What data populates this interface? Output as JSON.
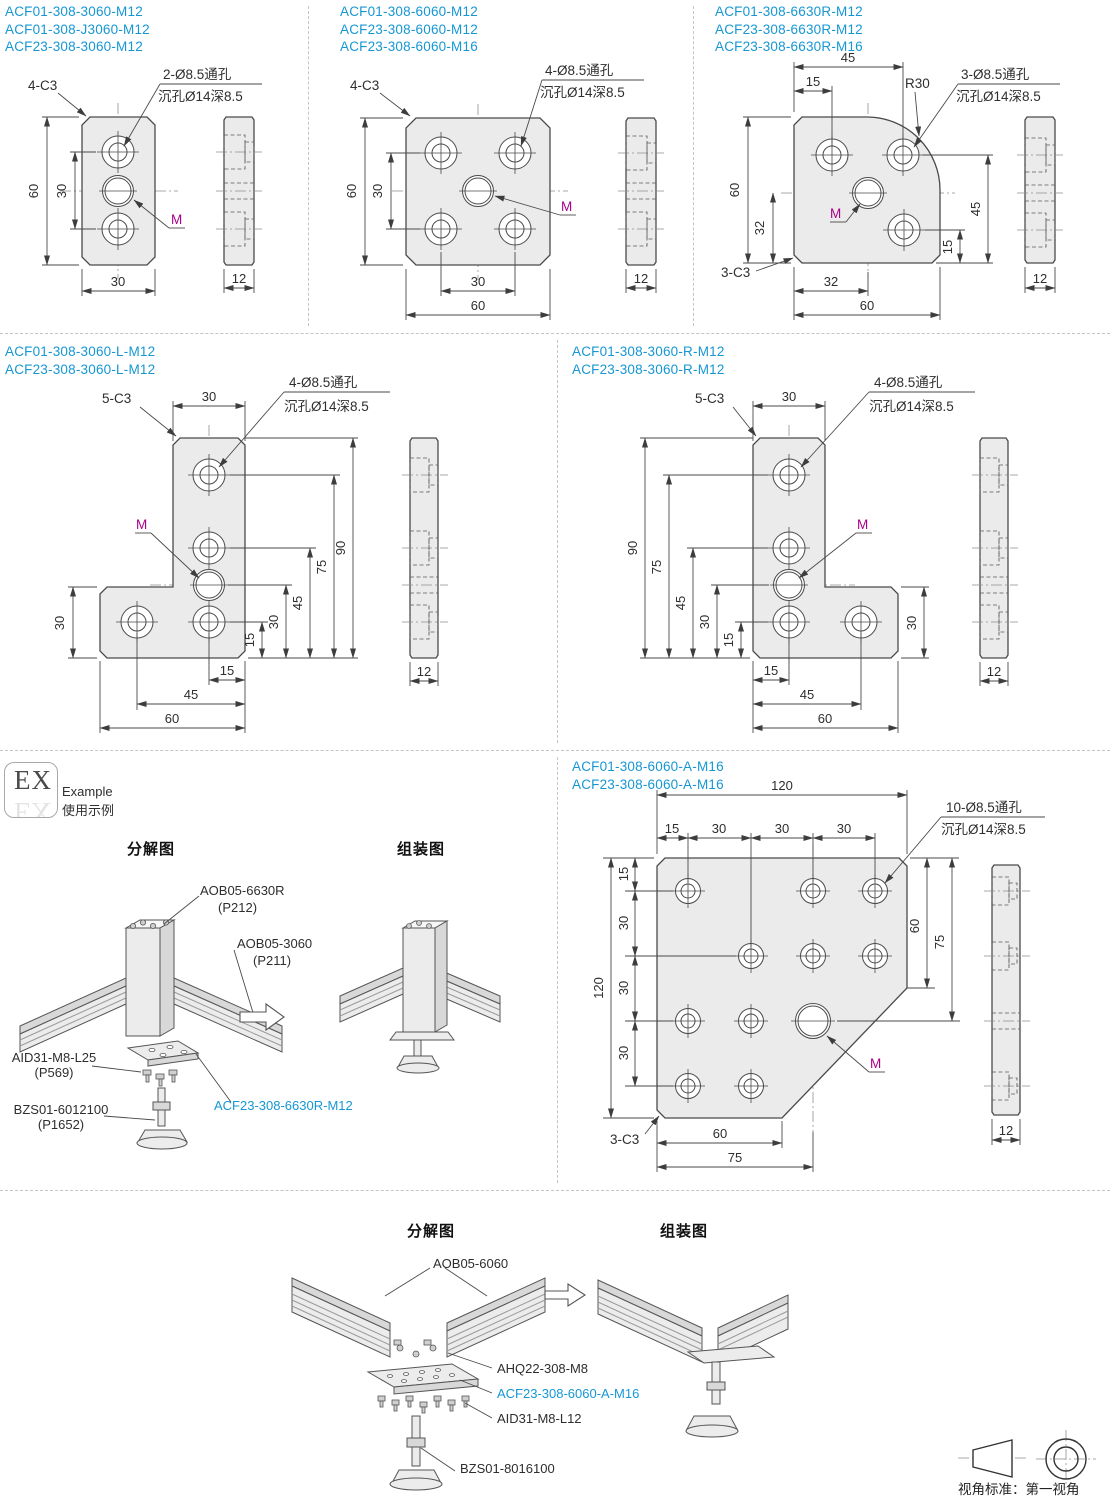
{
  "colors": {
    "accent_blue": "#1697d4",
    "m_magenta": "#aa0088",
    "line": "#4a4a4a",
    "plate_fill": "#ebebeb"
  },
  "row1": {
    "a": {
      "codes": [
        "ACF01-308-3060-M12",
        "ACF01-308-J3060-M12",
        "ACF23-308-3060-M12"
      ],
      "chamfer": "4-C3",
      "note1": "2-Ø8.5通孔",
      "note2": "沉孔Ø14深8.5",
      "m": "M",
      "h60": "60",
      "h30": "30",
      "w30": "30",
      "t12": "12"
    },
    "b": {
      "codes": [
        "ACF01-308-6060-M12",
        "ACF23-308-6060-M12",
        "ACF23-308-6060-M16"
      ],
      "chamfer": "4-C3",
      "note1": "4-Ø8.5通孔",
      "note2": "沉孔Ø14深8.5",
      "m": "M",
      "h60": "60",
      "h30": "30",
      "w30": "30",
      "w60": "60",
      "t12": "12"
    },
    "c": {
      "codes": [
        "ACF01-308-6630R-M12",
        "ACF23-308-6630R-M12",
        "ACF23-308-6630R-M16"
      ],
      "top45": "45",
      "top15": "15",
      "r30": "R30",
      "note1": "3-Ø8.5通孔",
      "note2": "沉孔Ø14深8.5",
      "l60": "60",
      "l32": "32",
      "m": "M",
      "r45": "45",
      "r15": "15",
      "chamfer": "3-C3",
      "b32": "32",
      "b60": "60",
      "t12": "12"
    }
  },
  "row2": {
    "l": {
      "codes": [
        "ACF01-308-3060-L-M12",
        "ACF23-308-3060-L-M12"
      ],
      "chamfer": "5-C3",
      "top30": "30",
      "note1": "4-Ø8.5通孔",
      "note2": "沉孔Ø14深8.5",
      "m": "M",
      "left30": "30",
      "b15": "15",
      "b45": "45",
      "b60": "60",
      "r15": "15",
      "r30": "30",
      "r45": "45",
      "r75": "75",
      "r90": "90",
      "t12": "12"
    },
    "r": {
      "codes": [
        "ACF01-308-3060-R-M12",
        "ACF23-308-3060-R-M12"
      ],
      "chamfer": "5-C3",
      "top30": "30",
      "note1": "4-Ø8.5通孔",
      "note2": "沉孔Ø14深8.5",
      "m": "M",
      "l90": "90",
      "l75": "75",
      "l45": "45",
      "l30": "30",
      "l15": "15",
      "b15": "15",
      "b45": "45",
      "b60": "60",
      "right30": "30",
      "t12": "12"
    }
  },
  "row3": {
    "ex": {
      "badge": "EX",
      "example_en": "Example",
      "example_zh": "使用示例",
      "h_exploded": "分解图",
      "h_assembled": "组装图",
      "aob_r": "AOB05-6630R",
      "aob_r_p": "(P212)",
      "aob": "AOB05-3060",
      "aob_p": "(P211)",
      "aid": "AID31-M8-L25",
      "aid_p": "(P569)",
      "bzs": "BZS01-6012100",
      "bzs_p": "(P1652)",
      "acf": "ACF23-308-6630R-M12"
    },
    "a": {
      "codes": [
        "ACF01-308-6060-A-M16",
        "ACF23-308-6060-A-M16"
      ],
      "t120": "120",
      "s15": "15",
      "s30a": "30",
      "s30b": "30",
      "s30c": "30",
      "note1": "10-Ø8.5通孔",
      "note2": "沉孔Ø14深8.5",
      "l15": "15",
      "l30a": "30",
      "l30b": "30",
      "l30c": "30",
      "l120": "120",
      "r60": "60",
      "r75": "75",
      "m": "M",
      "chamfer": "3-C3",
      "b60": "60",
      "b75": "75",
      "t12": "12"
    }
  },
  "row4": {
    "h_exploded": "分解图",
    "h_assembled": "组装图",
    "aob": "AOB05-6060",
    "ahq": "AHQ22-308-M8",
    "acf": "ACF23-308-6060-A-M16",
    "aid": "AID31-M8-L12",
    "bzs": "BZS01-8016100",
    "view_note": "视角标准：第一视角"
  }
}
